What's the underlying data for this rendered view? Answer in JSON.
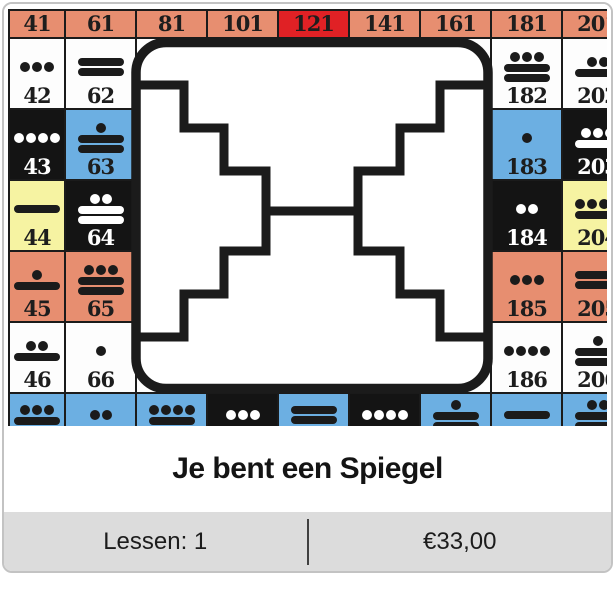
{
  "card": {
    "title": "Je bent een Spiegel",
    "footer": {
      "lessons": "Lessen: 1",
      "price": "€33,00"
    }
  },
  "colors": {
    "salmon": "#e78e70",
    "red": "#e02125",
    "blue": "#6cafe2",
    "yellow": "#f6f3a2",
    "black": "#141414",
    "white": "#fdfdfd",
    "grid_line": "#1b1b1b",
    "footer_bg": "#dcdcdc"
  },
  "mirror_symbol": {
    "name": "white-mirror-seal",
    "stroke": "#1b1b1b"
  },
  "grid": {
    "rows": [
      [
        {
          "kin": "41",
          "bg": "salmon",
          "header": true
        },
        {
          "kin": "61",
          "bg": "salmon",
          "header": true
        },
        {
          "kin": "81",
          "bg": "salmon",
          "header": true
        },
        {
          "kin": "101",
          "bg": "salmon",
          "header": true
        },
        {
          "kin": "121",
          "bg": "red",
          "header": true
        },
        {
          "kin": "141",
          "bg": "salmon",
          "header": true
        },
        {
          "kin": "161",
          "bg": "salmon",
          "header": true
        },
        {
          "kin": "181",
          "bg": "salmon",
          "header": true
        },
        {
          "kin": "201",
          "bg": "salmon",
          "header": true
        }
      ],
      [
        {
          "kin": "42",
          "tone": 3,
          "bg": "white"
        },
        {
          "kin": "62",
          "tone": 10,
          "bg": "white"
        },
        {
          "bg": "white"
        },
        {
          "bg": "white"
        },
        {
          "bg": "white"
        },
        {
          "bg": "white"
        },
        {
          "bg": "white"
        },
        {
          "kin": "182",
          "tone": 13,
          "bg": "white"
        },
        {
          "kin": "202",
          "tone": 7,
          "bg": "white"
        }
      ],
      [
        {
          "kin": "43",
          "tone": 4,
          "bg": "black"
        },
        {
          "kin": "63",
          "tone": 11,
          "bg": "blue"
        },
        {
          "bg": "white"
        },
        {
          "bg": "white"
        },
        {
          "bg": "white"
        },
        {
          "bg": "white"
        },
        {
          "bg": "white"
        },
        {
          "kin": "183",
          "tone": 1,
          "bg": "blue"
        },
        {
          "kin": "203",
          "tone": 8,
          "bg": "black"
        }
      ],
      [
        {
          "kin": "44",
          "tone": 5,
          "bg": "yellow"
        },
        {
          "kin": "64",
          "tone": 12,
          "bg": "black"
        },
        {
          "bg": "white"
        },
        {
          "bg": "white"
        },
        {
          "bg": "white"
        },
        {
          "bg": "white"
        },
        {
          "bg": "white"
        },
        {
          "kin": "184",
          "tone": 2,
          "bg": "black"
        },
        {
          "kin": "204",
          "tone": 9,
          "bg": "yellow"
        }
      ],
      [
        {
          "kin": "45",
          "tone": 6,
          "bg": "salmon"
        },
        {
          "kin": "65",
          "tone": 13,
          "bg": "salmon"
        },
        {
          "bg": "white"
        },
        {
          "bg": "white"
        },
        {
          "bg": "white"
        },
        {
          "bg": "white"
        },
        {
          "bg": "white"
        },
        {
          "kin": "185",
          "tone": 3,
          "bg": "salmon"
        },
        {
          "kin": "205",
          "tone": 10,
          "bg": "salmon"
        }
      ],
      [
        {
          "kin": "46",
          "tone": 7,
          "bg": "white"
        },
        {
          "kin": "66",
          "tone": 1,
          "bg": "white"
        },
        {
          "bg": "white"
        },
        {
          "bg": "white"
        },
        {
          "bg": "white"
        },
        {
          "bg": "white"
        },
        {
          "bg": "white"
        },
        {
          "kin": "186",
          "tone": 4,
          "bg": "white"
        },
        {
          "kin": "206",
          "tone": 11,
          "bg": "white"
        }
      ],
      [
        {
          "kin": "47",
          "tone": 8,
          "bg": "blue"
        },
        {
          "kin": "67",
          "tone": 2,
          "bg": "blue"
        },
        {
          "kin": "87",
          "tone": 9,
          "bg": "blue"
        },
        {
          "kin": "107",
          "tone": 3,
          "bg": "black"
        },
        {
          "kin": "127",
          "tone": 10,
          "bg": "blue"
        },
        {
          "kin": "147",
          "tone": 4,
          "bg": "black"
        },
        {
          "kin": "167",
          "tone": 11,
          "bg": "blue"
        },
        {
          "kin": "187",
          "tone": 5,
          "bg": "blue"
        },
        {
          "kin": "207",
          "tone": 12,
          "bg": "blue"
        }
      ]
    ]
  }
}
